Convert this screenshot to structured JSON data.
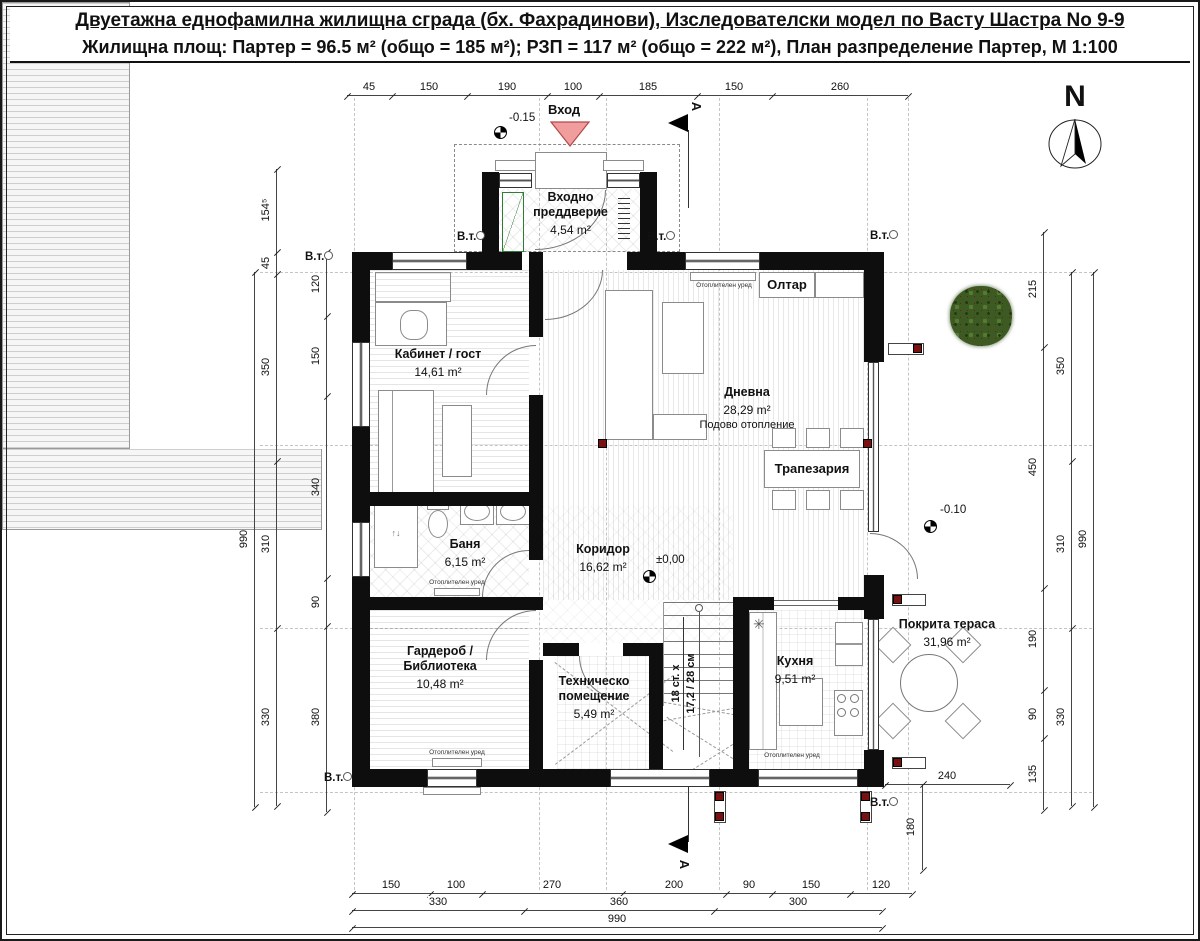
{
  "title": {
    "line1": "Двуетажна еднофамилна жилищна сграда (бх. Фахрадинови), Изследователски модел по Васту Шастра No 9-9",
    "line2": "Жилищна площ: Партер = 96.5 м² (общо = 185 м²); РЗП = 117 м² (общо = 222 м²), План разпределение Партер, М 1:100"
  },
  "north": {
    "label": "N"
  },
  "section_label": "А",
  "entrance": {
    "label": "Вход"
  },
  "levels": {
    "entrance": "-0.15",
    "zero": "±0,00",
    "terrace": "-0.10"
  },
  "vt_label": "В.т.",
  "rooms": [
    {
      "name": "Входно преддверие",
      "area": "4,54 m²"
    },
    {
      "name": "Кабинет / гост",
      "area": "14,61 m²"
    },
    {
      "name": "Дневна",
      "area": "28,29 m²",
      "note": "Подово отопление"
    },
    {
      "name": "Баня",
      "area": "6,15 m²"
    },
    {
      "name": "Коридор",
      "area": "16,62 m²"
    },
    {
      "name": "Гардероб / Библиотека",
      "area": "10,48 m²"
    },
    {
      "name": "Техническо помещение",
      "area": "5,49 m²"
    },
    {
      "name": "Кухня",
      "area": "9,51 m²"
    },
    {
      "name": "Покрита тераса",
      "area": "31,96 m²"
    }
  ],
  "fixtures": {
    "altar": "Олтар",
    "dining_table": "Трапезария",
    "heater": "Отоплителен уред",
    "stairs_line1": "18 ст. x",
    "stairs_line2": "17,2 / 28 см"
  },
  "dimensions": {
    "top": [
      "45",
      "150",
      "190",
      "100",
      "185",
      "150",
      "260"
    ],
    "left_mid": [
      "154⁵",
      "45",
      "350",
      "310",
      "330"
    ],
    "left_inner": [
      "120",
      "150",
      "340",
      "90",
      "380"
    ],
    "right_inner": [
      "215",
      "450",
      "190",
      "90",
      "135"
    ],
    "right_mid": [
      "350",
      "310",
      "330"
    ],
    "bottom_row1": [
      "150",
      "100",
      "270",
      "200",
      "90",
      "150",
      "120"
    ],
    "bottom_row2": [
      "330",
      "360",
      "300"
    ],
    "overall": "990",
    "terrace_width": "240",
    "terrace_depth": "180"
  },
  "colors": {
    "wall": "#0e0e0e",
    "column_red": "#7b1010",
    "entrance_arrow_fill": "#f29d9d",
    "entrance_arrow_stroke": "#b34a4a",
    "wardrobe_green": "#2f7d32"
  }
}
